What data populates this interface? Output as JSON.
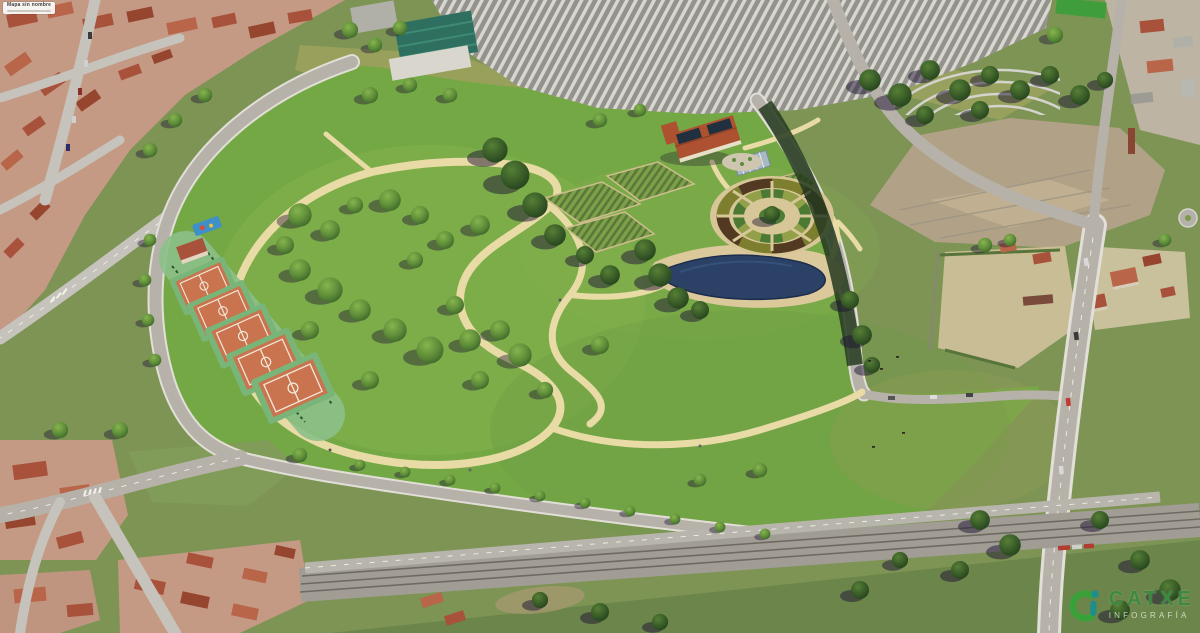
{
  "overlay": {
    "map_label": {
      "title": "Mapa sin nombre"
    },
    "logo": {
      "name": "CATXE",
      "tagline": "INFOGRAFÍA",
      "icon": "ci-monogram-icon",
      "colors": {
        "mark_green": "#3aa13a",
        "mark_teal": "#1f8d8b",
        "text_green": "#3c8a3f",
        "tagline_light": "#e9efe7"
      }
    }
  },
  "scene": {
    "description": "Aerial 3D photomontage of a park masterplan inserted into an urban periphery",
    "palette": {
      "context_green": "#7d9455",
      "park_green": "#74a845",
      "park_green_light": "#8fbb52",
      "sand_path": "#e8dba6",
      "road_gray": "#b6b2aa",
      "railway_gray": "#a19d95",
      "pond_blue": "#2c4166",
      "beach_sand": "#dcc99b",
      "clay_court": "#c9744e",
      "court_band_green": "#8cc089",
      "roof_red": "#a8523c",
      "urban_base": "#c59a85",
      "cemetery_gray": "#d8d7d1",
      "dirt_lot": "#b1a287",
      "tree_green": "#4a7c31",
      "shadow_dark": "#1e1433",
      "solar_panel": "#20303f",
      "farm_roof": "#ad5130",
      "greenhouse_gray": "#a8b8c4",
      "warehouse_teal": "#2f6f5f"
    },
    "features": [
      {
        "id": "park-meadow",
        "label": "Park meadow"
      },
      {
        "id": "loop-path",
        "label": "Sand walking loop"
      },
      {
        "id": "sports-courts",
        "label": "Clay sports courts",
        "count": 5
      },
      {
        "id": "circular-parterre-garden",
        "label": "Circular parterre garden"
      },
      {
        "id": "pond",
        "label": "Pond with sand beach"
      },
      {
        "id": "farmhouse",
        "label": "Farmhouse with solar panels"
      },
      {
        "id": "allotment-gardens",
        "label": "Allotment garden plots"
      },
      {
        "id": "greenhouse",
        "label": "Greenhouse"
      },
      {
        "id": "playground",
        "label": "Playground"
      },
      {
        "id": "cemetery",
        "label": "Cemetery rows"
      },
      {
        "id": "vacant-lot",
        "label": "Cleared dirt lot"
      },
      {
        "id": "railway-corridor",
        "label": "Railway corridor"
      },
      {
        "id": "city-blocks",
        "label": "Residential blocks"
      }
    ]
  }
}
